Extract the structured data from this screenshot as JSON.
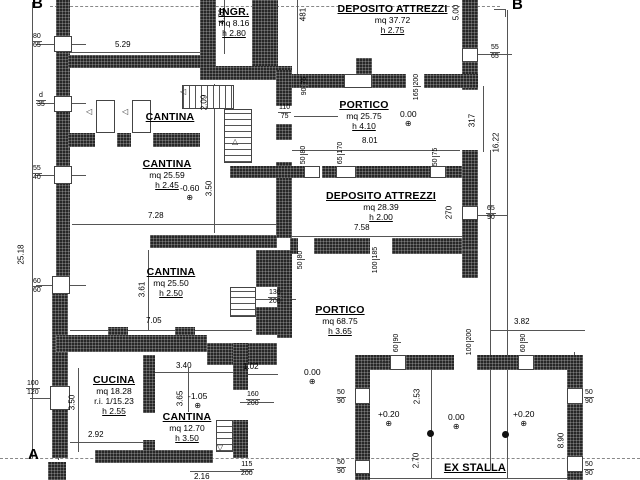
{
  "markers": {
    "section_b_left": "B",
    "section_b_right": "B",
    "section_a": "A"
  },
  "rooms": {
    "ingresso": {
      "name": "INGR.",
      "area": "mq 8.16",
      "height": "h 2.80"
    },
    "deposito_top": {
      "name": "DEPOSITO ATTREZZI",
      "area": "mq 37.72",
      "height": "h 2.75"
    },
    "cantina_label": {
      "name": "CANTINA"
    },
    "cantina_2559": {
      "name": "CANTINA",
      "area": "mq 25.59",
      "height": "h 2.45",
      "level": "-0.60"
    },
    "portico_top": {
      "name": "PORTICO",
      "area": "mq 25.75",
      "height": "h 4.10",
      "level": "0.00"
    },
    "deposito_mid": {
      "name": "DEPOSITO ATTREZZI",
      "area": "mq 28.39",
      "height": "h 2.00"
    },
    "cantina_2550": {
      "name": "CANTINA",
      "area": "mq 25.50",
      "height": "h 2.50"
    },
    "portico_big": {
      "name": "PORTICO",
      "area": "mq 68.75",
      "height": "h 3.65"
    },
    "cucina": {
      "name": "CUCINA",
      "area": "mq 18.28",
      "ratio": "r.i. 1/15.23",
      "height": "h 2.55"
    },
    "cantina_1270": {
      "name": "CANTINA",
      "area": "mq 12.70",
      "height": "h 3.50",
      "level": "-1.05"
    },
    "ex_stalla": {
      "name": "EX STALLA",
      "level_left": "+0.20",
      "level_center": "0.00",
      "level_right": "+0.20",
      "level_outside": "0.00"
    }
  },
  "dims": {
    "h529": "5.29",
    "h801": "8.01",
    "h728": "7.28",
    "h758": "7.58",
    "h705": "7.05",
    "h382": "3.82",
    "h340": "3.40",
    "h102": "1.02",
    "h292": "2.92",
    "h216": "2.16",
    "v470": "4.70",
    "v481": "481",
    "v500": "5.00",
    "v209": "2.09",
    "v350a": "3.50",
    "v317": "317",
    "v1622": "16.22",
    "v2518": "25.18",
    "v361": "3.61",
    "v270": "270",
    "v365": "3.65",
    "v350b": "3.50",
    "v253": "2.53",
    "v270b": "2.70",
    "v890": "8.90"
  },
  "openings": {
    "o8065": {
      "w": "80",
      "h": "65"
    },
    "od35": {
      "w": "d",
      "h": "35"
    },
    "o5565": {
      "w": "55",
      "h": "65"
    },
    "o11075": {
      "w": "110",
      "h": "75"
    },
    "o5540": {
      "w": "55",
      "h": "40"
    },
    "o6060": {
      "w": "60",
      "h": "60"
    },
    "o9075": {
      "w": "90",
      "h": "75"
    },
    "o165200": {
      "w": "165",
      "h": "200"
    },
    "o5080a": {
      "w": "50",
      "h": "80"
    },
    "o65170": {
      "w": "65",
      "h": "170"
    },
    "o5075": {
      "w": "50",
      "h": "75"
    },
    "o6590": {
      "w": "65",
      "h": "90"
    },
    "o130200": {
      "w": "130",
      "h": "200"
    },
    "o5080b": {
      "w": "50",
      "h": "80"
    },
    "o100185": {
      "w": "100",
      "h": "185"
    },
    "o100120": {
      "w": "100",
      "h": "120"
    },
    "o160200": {
      "w": "160",
      "h": "200"
    },
    "o6090a": {
      "w": "60",
      "h": "90"
    },
    "o100200": {
      "w": "100",
      "h": "200"
    },
    "o6090b": {
      "w": "60",
      "h": "90"
    },
    "o5090a": {
      "w": "50",
      "h": "90"
    },
    "o5090b": {
      "w": "50",
      "h": "90"
    },
    "o5090c": {
      "w": "50",
      "h": "90"
    },
    "o5090d": {
      "w": "50",
      "h": "90"
    },
    "o115200": {
      "w": "115",
      "h": "200"
    }
  },
  "symbols": {
    "level_marker": "⊕",
    "tri_left": "◁",
    "tri_up": "△",
    "tri_down": "▽"
  }
}
